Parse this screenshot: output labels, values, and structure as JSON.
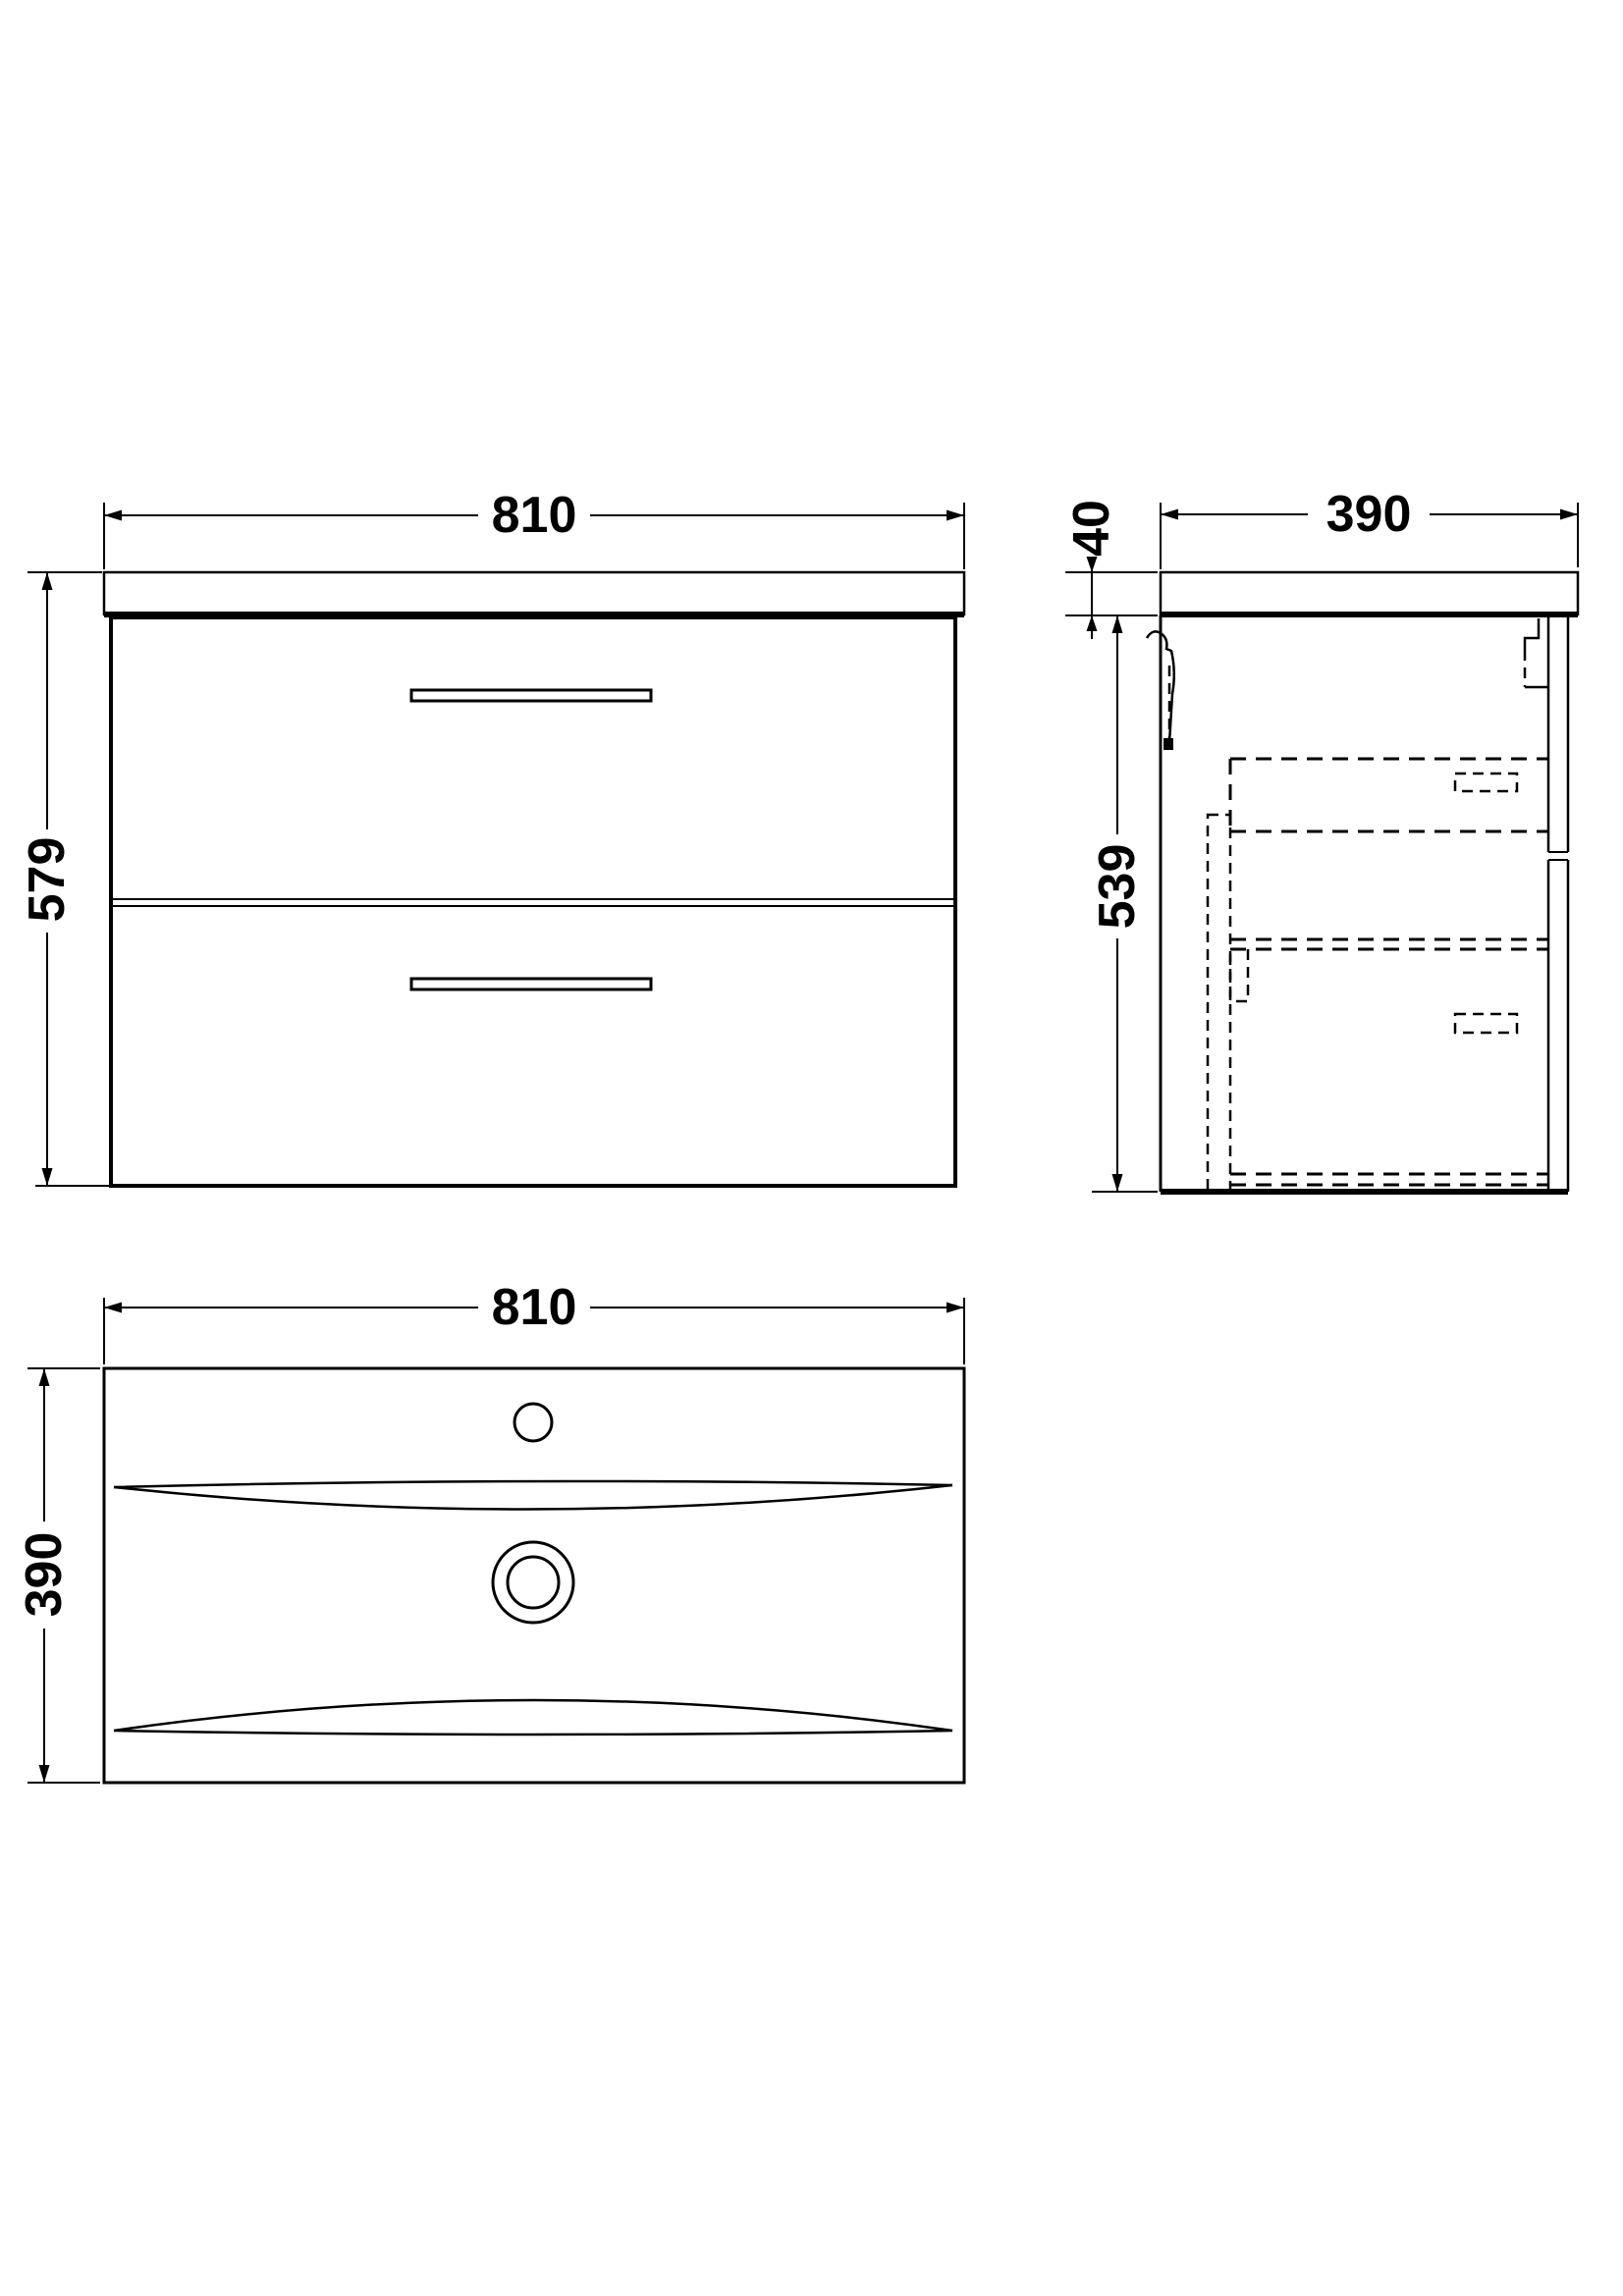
{
  "page": {
    "background": "#ffffff",
    "line_color": "#000000",
    "drawing_type": "bathroom vanity unit technical drawing, three orthographic views"
  },
  "front_view": {
    "name": "front elevation of wall-hung two-drawer vanity unit with basin top",
    "width_dim": "810",
    "height_dim": "579"
  },
  "side_view": {
    "name": "side section showing wall bracket and hidden drawer boxes",
    "depth_dim": "390",
    "top_thickness_dim": "40",
    "body_height_dim": "539"
  },
  "plan_view": {
    "name": "plan view of basin with tap hole and waste",
    "width_dim": "810",
    "depth_dim": "390"
  }
}
